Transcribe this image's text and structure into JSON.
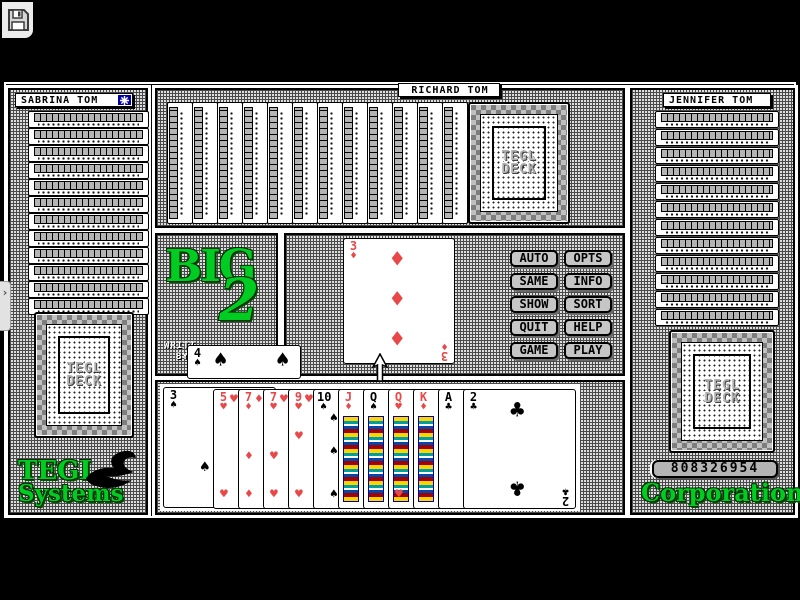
{
  "app": {
    "icons": {
      "save": "floppy-disk",
      "turn_indicator": "star-burst",
      "edge_tab": "chevron-right",
      "mouse_cursor": "arrow-up",
      "tegl_logo": "swan"
    },
    "colors": {
      "accent_green": "#00CC22",
      "card_red": "#E84848",
      "indicator_blue": "#0000AA",
      "button_face": "#C6C6C6"
    }
  },
  "players": {
    "left": {
      "name": "SABRINA TOM",
      "hidden_cards": 13
    },
    "top": {
      "name": "RICHARD TOM",
      "hidden_cards": 13
    },
    "right": {
      "name": "JENNIFER TOM",
      "hidden_cards": 13
    }
  },
  "table": {
    "played_card": {
      "rank": "3",
      "suit": "diamonds",
      "suit_glyph": "♦",
      "color": "red"
    },
    "side_card": {
      "rank": "4",
      "suit": "spades",
      "suit_glyph": "♠",
      "color": "black"
    }
  },
  "hand": {
    "cards": [
      {
        "rank": "3",
        "suit": "spades",
        "suit_glyph": "♠",
        "color": "black"
      },
      {
        "rank": "5",
        "suit": "hearts",
        "suit_glyph": "♥",
        "color": "red"
      },
      {
        "rank": "7",
        "suit": "diamonds",
        "suit_glyph": "♦",
        "color": "red"
      },
      {
        "rank": "7",
        "suit": "hearts",
        "suit_glyph": "♥",
        "color": "red"
      },
      {
        "rank": "9",
        "suit": "hearts",
        "suit_glyph": "♥",
        "color": "red"
      },
      {
        "rank": "10",
        "suit": "spades",
        "suit_glyph": "♠",
        "color": "black"
      },
      {
        "rank": "J",
        "suit": "diamonds",
        "suit_glyph": "♦",
        "color": "red"
      },
      {
        "rank": "Q",
        "suit": "spades",
        "suit_glyph": "♠",
        "color": "black"
      },
      {
        "rank": "Q",
        "suit": "hearts",
        "suit_glyph": "♥",
        "color": "red"
      },
      {
        "rank": "K",
        "suit": "diamonds",
        "suit_glyph": "♦",
        "color": "red"
      },
      {
        "rank": "A",
        "suit": "clubs",
        "suit_glyph": "♣",
        "color": "black"
      },
      {
        "rank": "2",
        "suit": "clubs",
        "suit_glyph": "♣",
        "color": "black"
      }
    ]
  },
  "buttons": [
    {
      "label": "AUTO"
    },
    {
      "label": "OPTS"
    },
    {
      "label": "SAME"
    },
    {
      "label": "INFO"
    },
    {
      "label": "SHOW"
    },
    {
      "label": "SORT"
    },
    {
      "label": "QUIT"
    },
    {
      "label": "HELP"
    },
    {
      "label": "GAME"
    },
    {
      "label": "PLAY"
    }
  ],
  "logo": {
    "word": "BIG",
    "numeral": "2",
    "credit_line1": "WRITT",
    "credit_line2": "BY"
  },
  "deck_back": {
    "line1": "TEGL",
    "line2": "DECK"
  },
  "branding": {
    "left_top": "TEGL",
    "left_bottom": "Systems",
    "right_serial": "808326954",
    "right_bottom": "Corporation"
  }
}
